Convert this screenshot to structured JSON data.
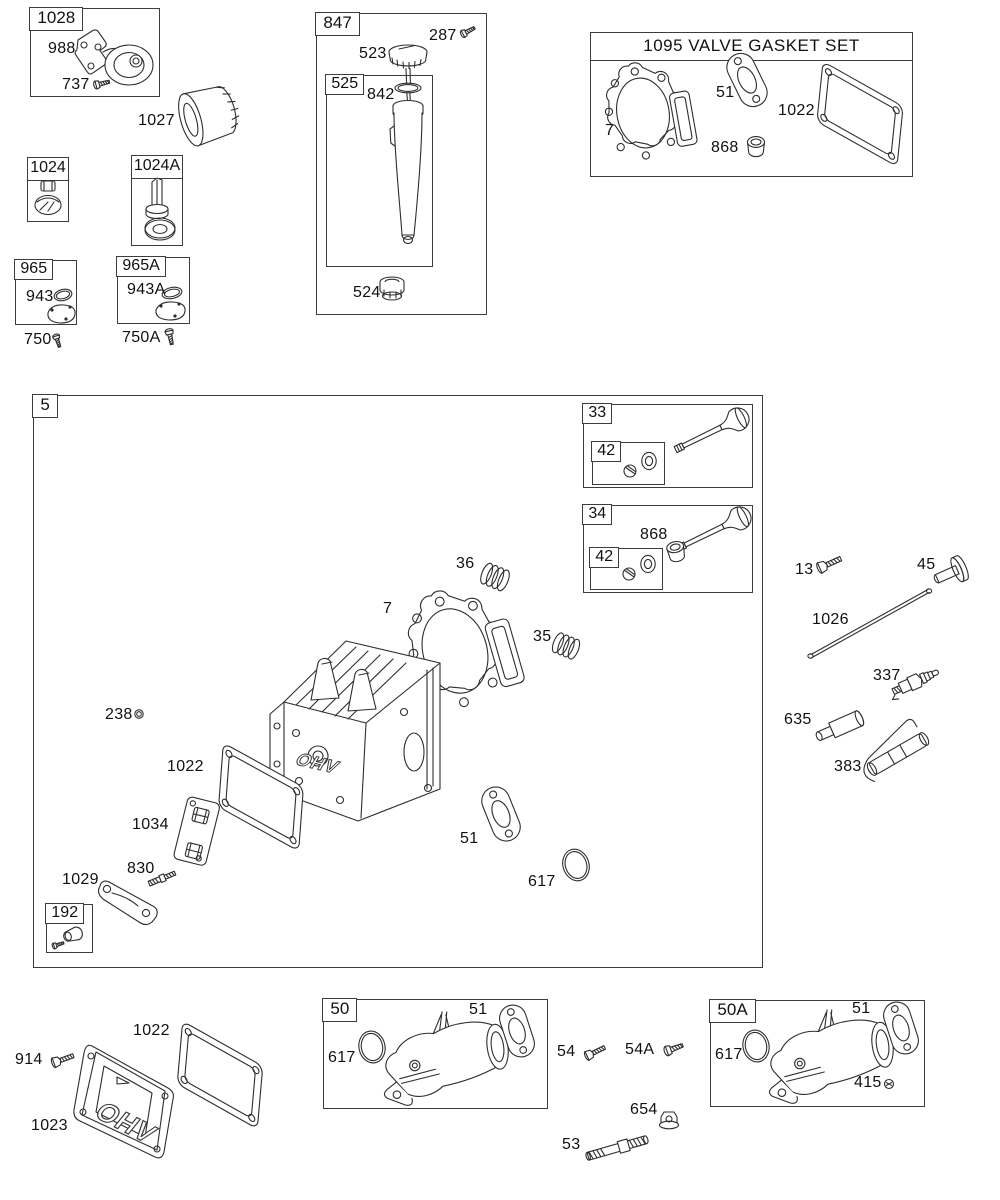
{
  "diagram": {
    "background": "#ffffff",
    "line_color": "#3d3d3d",
    "gasket_set_title": "1095 VALVE GASKET SET",
    "cast_text": "OHV",
    "parts": {
      "n5": "5",
      "n7": "7",
      "n13": "13",
      "n33": "33",
      "n34": "34",
      "n35": "35",
      "n36": "36",
      "n42": "42",
      "n45": "45",
      "n50": "50",
      "n50A": "50A",
      "n51": "51",
      "n53": "53",
      "n54": "54",
      "n54A": "54A",
      "n192": "192",
      "n238": "238",
      "n287": "287",
      "n337": "337",
      "n383": "383",
      "n415": "415",
      "n523": "523",
      "n524": "524",
      "n525": "525",
      "n617": "617",
      "n635": "635",
      "n654": "654",
      "n737": "737",
      "n750": "750",
      "n750A": "750A",
      "n830": "830",
      "n842": "842",
      "n847": "847",
      "n868": "868",
      "n914": "914",
      "n943": "943",
      "n943A": "943A",
      "n965": "965",
      "n965A": "965A",
      "n988": "988",
      "n1022": "1022",
      "n1023": "1023",
      "n1024": "1024",
      "n1024A": "1024A",
      "n1026": "1026",
      "n1027": "1027",
      "n1028": "1028",
      "n1029": "1029",
      "n1034": "1034"
    },
    "groups": {
      "g1028": {
        "label": "1028",
        "contains": [
          "988",
          "737"
        ]
      },
      "g1024": {
        "label": "1024",
        "contains": []
      },
      "g1024A": {
        "label": "1024A",
        "contains": []
      },
      "g965": {
        "label": "965",
        "contains": [
          "943"
        ]
      },
      "g965A": {
        "label": "965A",
        "contains": [
          "943A"
        ]
      },
      "g847": {
        "label": "847",
        "contains": [
          "287",
          "523",
          "525",
          "524"
        ]
      },
      "g525": {
        "label": "525",
        "contains": [
          "842"
        ]
      },
      "g1095": {
        "label": "1095 VALVE GASKET SET",
        "contains": [
          "7",
          "51",
          "868",
          "1022"
        ]
      },
      "g5": {
        "label": "5",
        "contains": [
          "33",
          "34",
          "36",
          "35",
          "7",
          "238",
          "1022",
          "1034",
          "830",
          "1029",
          "192",
          "51",
          "617"
        ]
      },
      "g33": {
        "label": "33",
        "contains": [
          "42"
        ]
      },
      "g34": {
        "label": "34",
        "contains": [
          "42",
          "868"
        ]
      },
      "g192": {
        "label": "192",
        "contains": []
      },
      "g50": {
        "label": "50",
        "contains": [
          "617",
          "51"
        ]
      },
      "g50A": {
        "label": "50A",
        "contains": [
          "617",
          "51",
          "415"
        ]
      }
    },
    "loose_parts": [
      "1027",
      "750",
      "750A",
      "13",
      "45",
      "1026",
      "337",
      "635",
      "383",
      "914",
      "1022",
      "1023",
      "54",
      "54A",
      "654",
      "53"
    ]
  }
}
